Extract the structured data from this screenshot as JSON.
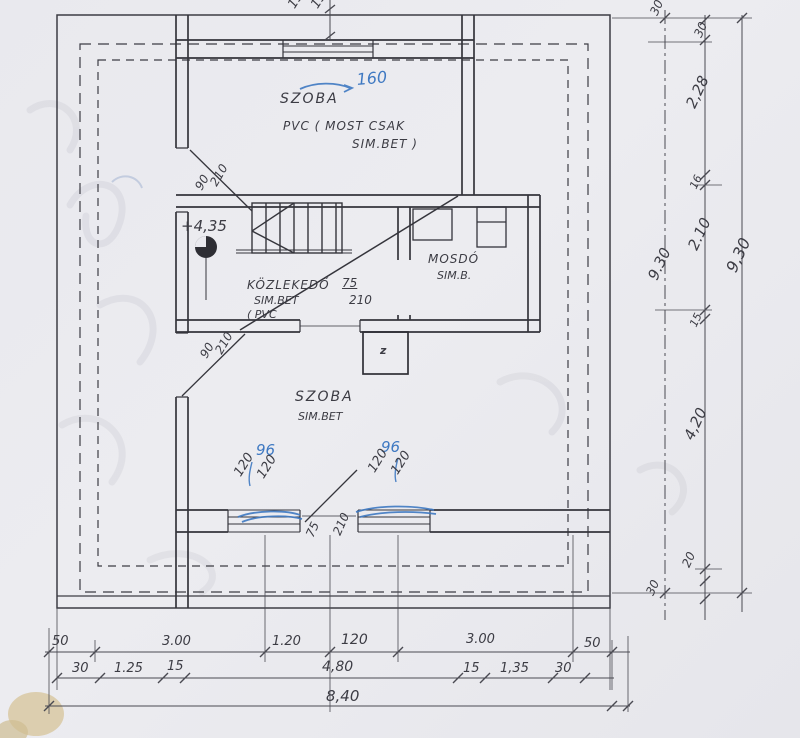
{
  "rooms": {
    "szoba_top": {
      "name": "SZOBA",
      "finish_1": "PVC ( MOST CSAK",
      "finish_2": "SIM.BET )"
    },
    "kozlekedo": {
      "name": "KÖZLEKEDŐ",
      "finish_1": "SIM.BET",
      "finish_2": "( PVC"
    },
    "mosdo": {
      "name": "MOSDÓ",
      "finish": "SIM.B."
    },
    "szoba_bottom": {
      "name": "SZOBA",
      "finish": "SIM.BET"
    }
  },
  "level_mark": "+4,35",
  "chimney_mark": "z",
  "openings": {
    "door_top": {
      "width": "90",
      "height": "210"
    },
    "door_bottom": {
      "width": "90",
      "height": "210"
    },
    "door_hall": {
      "width": "75",
      "height": "210"
    },
    "door_room": {
      "width": "75",
      "height": "210"
    },
    "window_left": {
      "width": "120",
      "height": "120"
    },
    "window_right": {
      "width": "120",
      "height": "120"
    }
  },
  "blue_notes": {
    "window_top": "160",
    "window_left": "96",
    "window_right": "96"
  },
  "dims": {
    "top": [
      "150",
      "150"
    ],
    "bottom_row1": [
      "50",
      "3.00",
      "1.20",
      "120",
      "3.00",
      "50"
    ],
    "bottom_row2": [
      "30",
      "1.25",
      "15",
      "4,80",
      "15",
      "1,35",
      "30"
    ],
    "bottom_total": "8,40",
    "right": {
      "outer_top": "30",
      "col": [
        "30",
        "2,28",
        "16",
        "2.10",
        "15",
        "4,20",
        "20"
      ],
      "inner_total": "9.30",
      "outer_total": "9,30",
      "outer_bottom": "30"
    }
  },
  "colors": {
    "ink": "#3c3c44",
    "blue_ink": "#3f79c2",
    "paper": "#e9e9ee"
  }
}
